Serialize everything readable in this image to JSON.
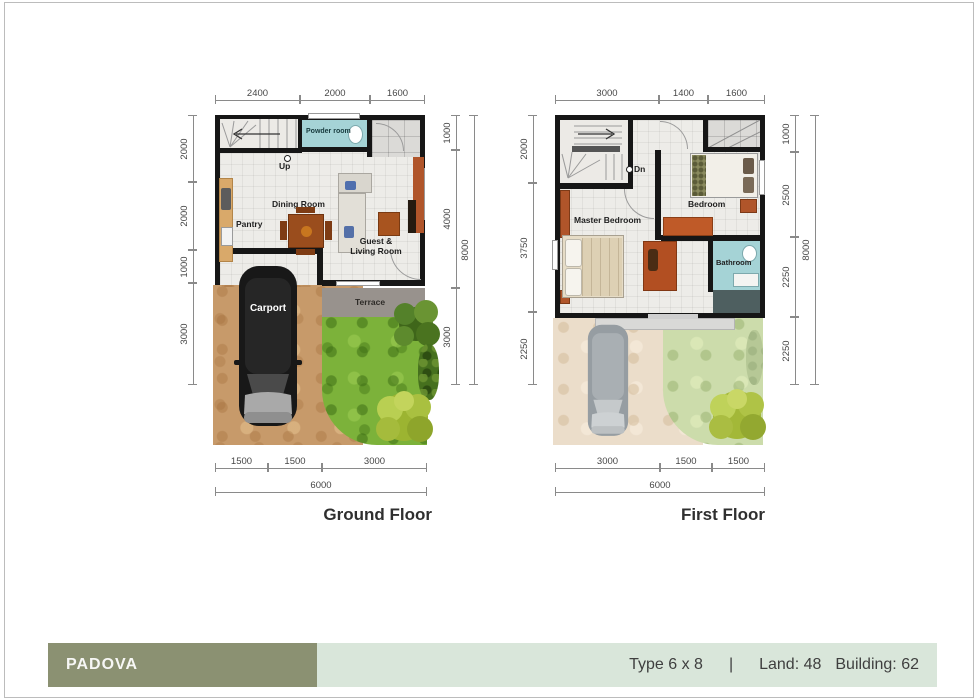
{
  "banner": {
    "name": "PADOVA",
    "type_label": "Type 6 x 8",
    "separator": "|",
    "land_label": "Land: 48",
    "building_label": "Building: 62",
    "olive_color": "#8b9172",
    "light_color": "#d9e6da"
  },
  "ground_floor": {
    "title": "Ground Floor",
    "dims_top": [
      "2400",
      "2000",
      "1600"
    ],
    "dims_left": [
      "2000",
      "2000",
      "1000",
      "3000"
    ],
    "dims_right": [
      "1000",
      "4000",
      "3000"
    ],
    "dims_right_total": "8000",
    "dims_bottom": [
      "1500",
      "1500",
      "3000"
    ],
    "dims_bottom_total": "6000",
    "rooms": {
      "powder_room": "Powder room",
      "stairs_up": "Up",
      "pantry": "Pantry",
      "dining_room": "Dining Room",
      "guest_living": "Guest & Living Room",
      "terrace": "Terrace",
      "carport": "Carport"
    }
  },
  "first_floor": {
    "title": "First Floor",
    "dims_top": [
      "3000",
      "1400",
      "1600"
    ],
    "dims_left": [
      "2000",
      "3750",
      "2250"
    ],
    "dims_right": [
      "1000",
      "2500",
      "2250",
      "2250"
    ],
    "dims_right_total": "8000",
    "dims_bottom": [
      "3000",
      "1500",
      "1500"
    ],
    "dims_bottom_total": "6000",
    "rooms": {
      "stairs_down": "Dn",
      "master_bedroom": "Master Bedroom",
      "bedroom": "Bedroom",
      "bathroom": "Bathroom"
    }
  },
  "palette": {
    "wall": "#161616",
    "tile": "#edece8",
    "teal": "#a5d3d6",
    "grass": "#7cb23a",
    "dirt": "#c79a6a",
    "terrace_gray": "#98928d",
    "furniture_orange": "#b0552a",
    "faded_grass": "#ccdcab",
    "faded_dirt": "#ebddca"
  }
}
